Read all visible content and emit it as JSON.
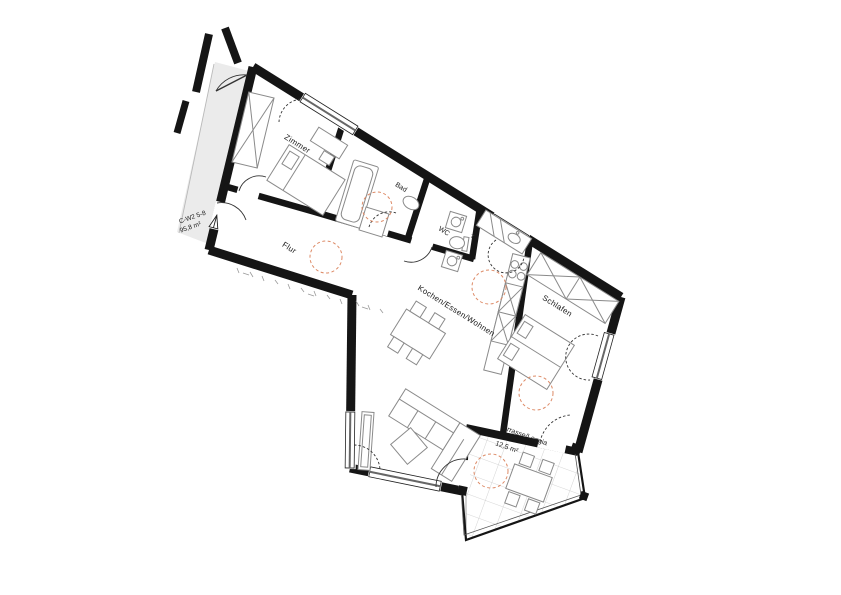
{
  "plan": {
    "rooms": {
      "zimmer": {
        "label": "Zimmer"
      },
      "bad": {
        "label": "Bad"
      },
      "flur": {
        "label": "Flur"
      },
      "wc": {
        "label": "WC"
      },
      "wohnen": {
        "label": "Kochen/Essen/Wohnen"
      },
      "schlafen": {
        "label": "Schlafen"
      },
      "terrasse": {
        "label": "Terrasse/Loggia",
        "area": "12,5 m²"
      }
    },
    "unit": {
      "code": "C-W2 5-8",
      "area": "95,8 m²"
    },
    "appliances": {
      "dryer_label": "T"
    },
    "colors": {
      "wall": "#151515",
      "furniture": "#8a8a8a",
      "turning_circle": "#dd8a66",
      "corridor": "#ebebeb",
      "tile_grid": "#c9c9c9"
    }
  }
}
